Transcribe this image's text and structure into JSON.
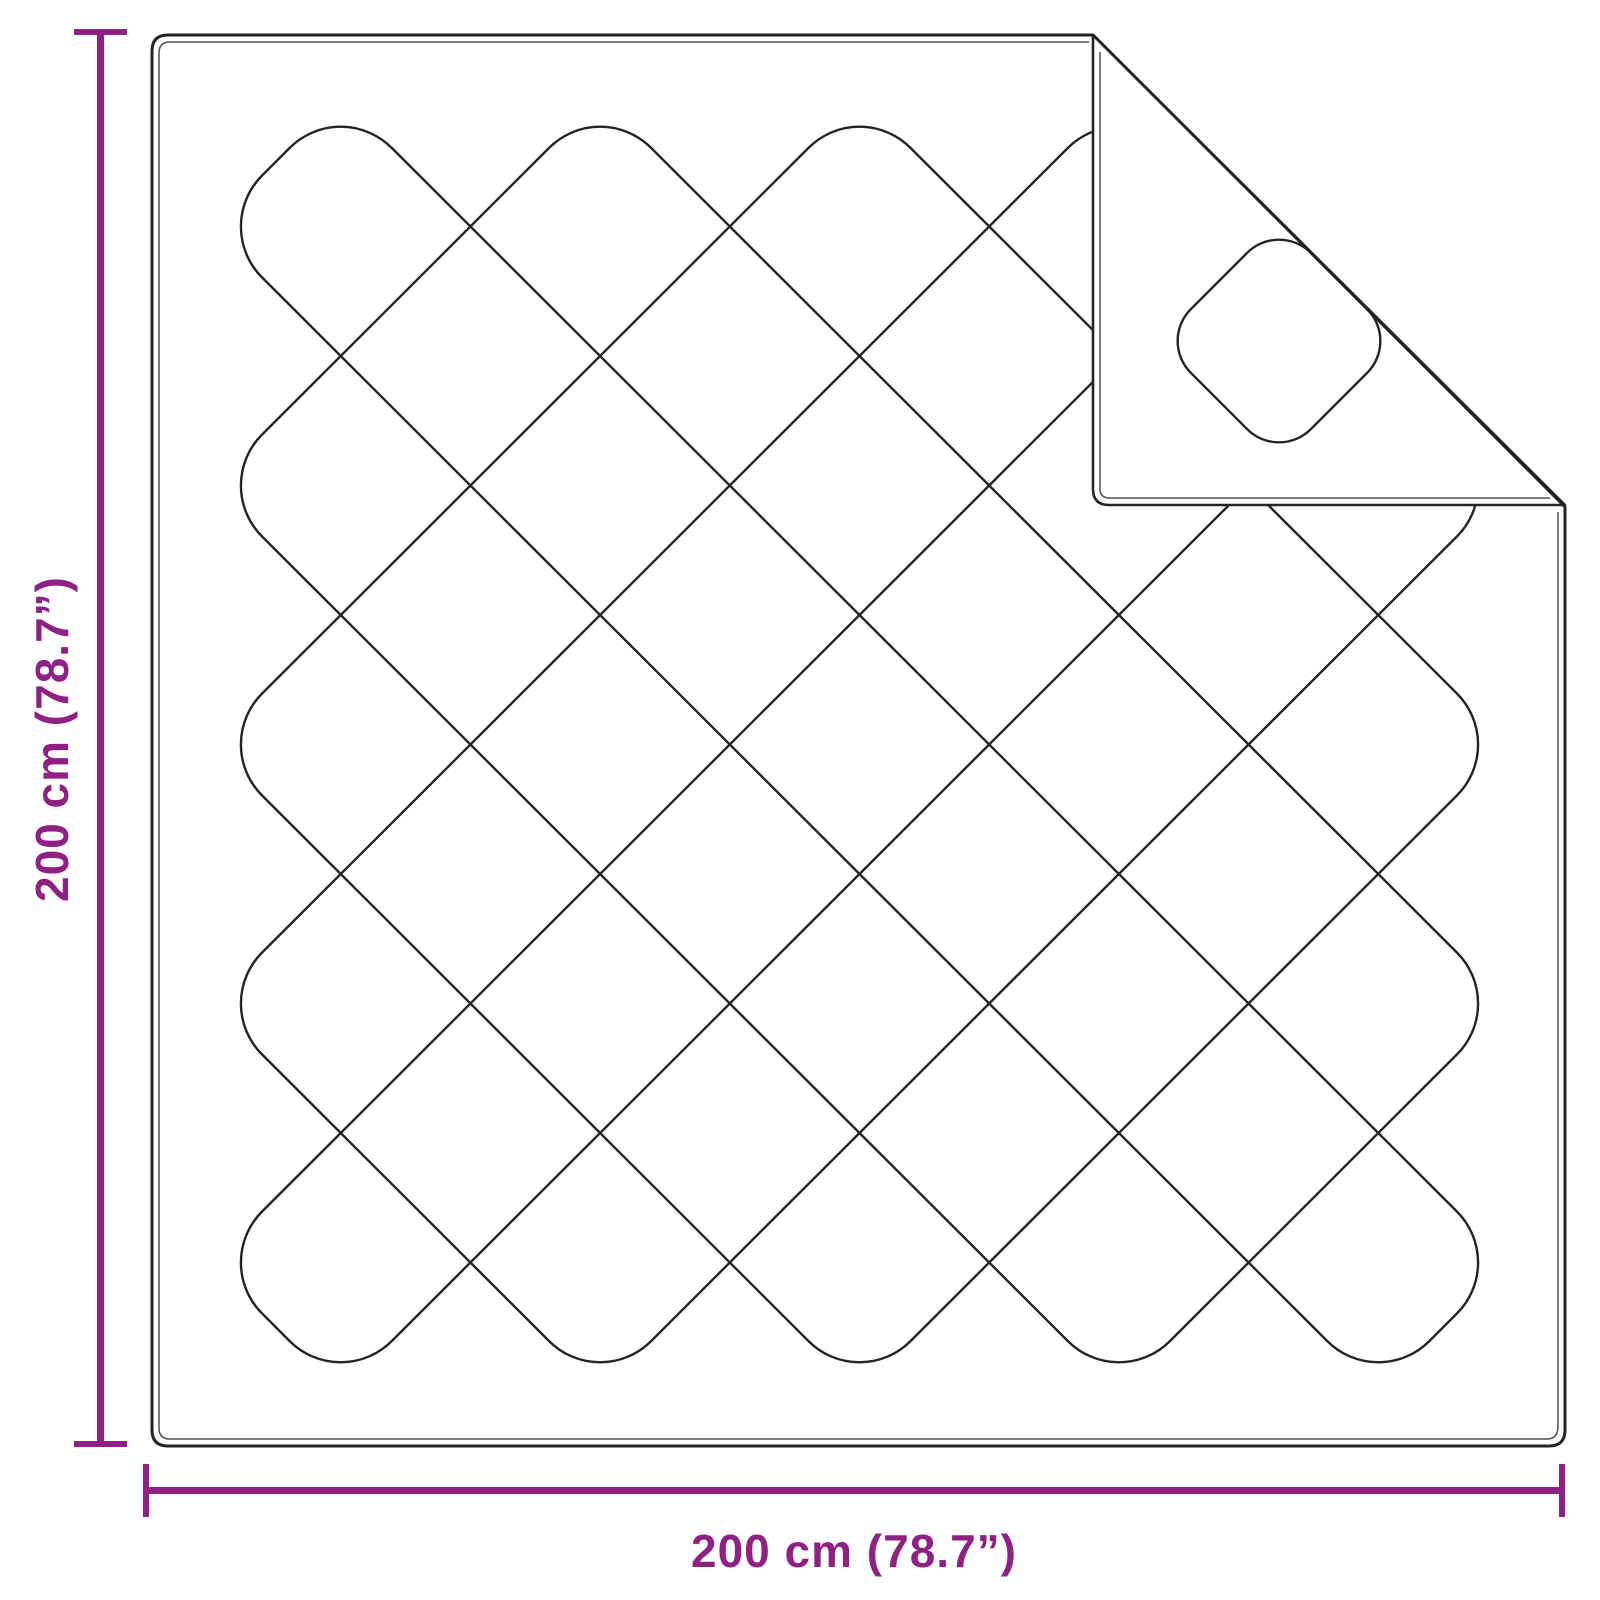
{
  "figure": {
    "type": "quilted-blanket-top-view",
    "folded_corner": "top-right"
  },
  "dimensions": {
    "height_label": "200 cm (78.7”)",
    "width_label": "200 cm (78.7”)"
  },
  "colors": {
    "accent": "#8F2185",
    "line": "#242424",
    "background": "#FFFFFF"
  }
}
